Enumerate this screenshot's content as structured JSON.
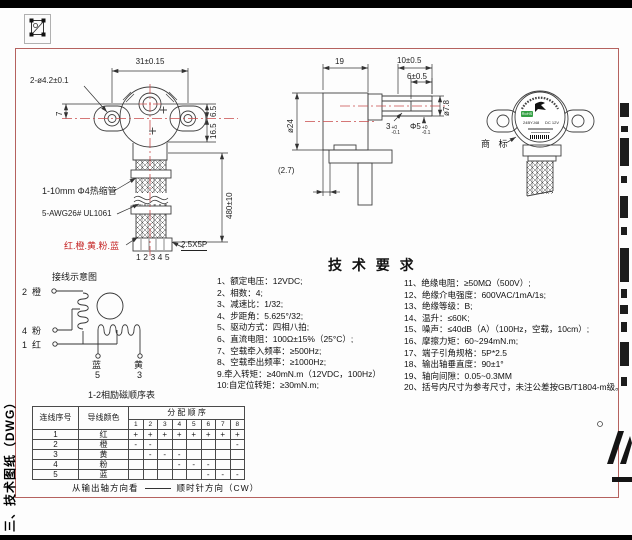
{
  "side_label": "三、技术图纸（DWG）",
  "front_view": {
    "dim_hole_spacing": "31±0.15",
    "dim_holes": "2-ø4.2±0.1",
    "dim_offset": "7",
    "dim_6_5": "6.5",
    "dim_16_5": "16.5",
    "dim_wire_length": "480±10",
    "label_heatshrink": "1-10mm Φ4热缩管",
    "label_wire_spec": "5-AWG26# UL1061",
    "label_wire_colors": "红.橙.黄.粉.蓝",
    "label_pin_numbers": "12345",
    "label_connector": "2.5X5P"
  },
  "side_view": {
    "dim_body_length": "19",
    "dim_shaft_length": "10±0.5",
    "dim_flat_length": "6±0.5",
    "dim_boss_dia": "ø7.8",
    "dim_body_dia": "ø24",
    "dim_plate": "(2.7)",
    "dim_flat_width": "3",
    "dim_flat_tol_sup": "+0",
    "dim_flat_tol_sub": "-0.1",
    "dim_shaft_dia": "Φ5",
    "dim_shaft_tol_sup": "+0",
    "dim_shaft_tol_sub": "-0.1"
  },
  "trademark_view": {
    "callout": "商 标",
    "rohs": "RoHS",
    "model": "24BYJ48",
    "voltage": "DC 12V"
  },
  "tech_requirements": {
    "title": "技 术 要 求",
    "left": [
      "1、额定电压：12VDC;",
      "2、相数：4;",
      "3、减速比：1/32;",
      "4、步距角：5.625°/32;",
      "5、驱动方式：四相八拍;",
      "6、直流电阻：100Ω±15%（25°C）;",
      "7、空载牵入频率：≥500Hz;",
      "8、空载牵出频率：≥1000Hz;",
      "9.牵入转矩：≥40mN.m（12VDC，100Hz）",
      "10:自定位转矩：≥30mN.m;"
    ],
    "right": [
      "11、绝缘电阻：≥50MΩ（500V）;",
      "12、绝缘介电强度：600VAC/1mA/1s;",
      "13、绝缘等级：B;",
      "14、温升：≤60K;",
      "15、噪声：≤40dB（A）（100Hz，空载，10cm）;",
      "16、摩擦力矩：60~294mN.m;",
      "17、端子引角规格：5P*2.5",
      "18、输出轴垂直度：90±1°",
      "19、轴向间隙：0.05~0.3MM",
      "20、括号内尺寸为参考尺寸，未注公差按GB/T1804-m级。"
    ]
  },
  "wiring_diagram": {
    "title": "接线示意图",
    "terminal_2": {
      "num": "2",
      "color": "橙"
    },
    "terminal_4": {
      "num": "4",
      "color": "粉"
    },
    "terminal_1": {
      "num": "1",
      "color": "红"
    },
    "terminal_5": {
      "color": "蓝",
      "num": "5"
    },
    "terminal_3": {
      "color": "黄",
      "num": "3"
    }
  },
  "sequence_table": {
    "title": "1-2相励磁顺序表",
    "header_col1": "连线序号",
    "header_col2": "导线颜色",
    "header_span": "分 配 顺 序",
    "step_numbers": [
      "1",
      "2",
      "3",
      "4",
      "5",
      "6",
      "7",
      "8"
    ],
    "rows": [
      {
        "no": "1",
        "color": "红",
        "cells": [
          "+",
          "+",
          "+",
          "+",
          "+",
          "+",
          "+",
          "+"
        ]
      },
      {
        "no": "2",
        "color": "橙",
        "cells": [
          "-",
          "-",
          "",
          "",
          "",
          "",
          "",
          "-"
        ]
      },
      {
        "no": "3",
        "color": "黄",
        "cells": [
          "",
          "-",
          "-",
          "-",
          "",
          "",
          "",
          ""
        ]
      },
      {
        "no": "4",
        "color": "粉",
        "cells": [
          "",
          "",
          "",
          "-",
          "-",
          "-",
          "",
          ""
        ]
      },
      {
        "no": "5",
        "color": "蓝",
        "cells": [
          "",
          "",
          "",
          "",
          "",
          "-",
          "-",
          "-"
        ]
      }
    ],
    "footer_view": "从输出轴方向看",
    "footer_direction": "顺时针方向（CW）"
  },
  "colors": {
    "frame_border": "#b5625f",
    "centerline_red": "#c84b4b",
    "wire_colors_text": "#c42222",
    "rohs_green": "#33a043"
  }
}
